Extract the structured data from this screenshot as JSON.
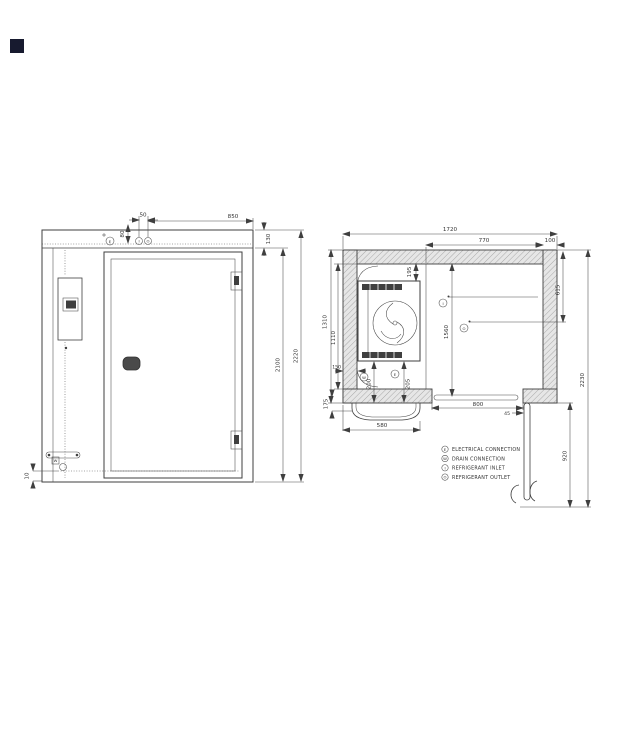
{
  "logo": {
    "color": "#171a2f"
  },
  "front_view": {
    "dims": {
      "d50": "50",
      "d850": "850",
      "d80": "80",
      "d130": "130",
      "d2100": "2100",
      "d2220": "2220",
      "d10": "10"
    },
    "symbols": {
      "electrical": "E",
      "inlet": "I",
      "outlet": "O",
      "drain": "W"
    }
  },
  "plan_view": {
    "dims": {
      "d1720": "1720",
      "d770": "770",
      "d100": "100",
      "d1310": "1310",
      "d1110": "1110",
      "d195": "195",
      "d150": "150",
      "d200": "200",
      "d205": "205",
      "d580": "580",
      "d175": "175",
      "d800": "800",
      "d45": "45",
      "d615": "615",
      "d1560": "1560",
      "d920": "920",
      "d2230": "2230"
    },
    "symbols": {
      "drain": "W",
      "electrical": "E",
      "inlet": "I",
      "outlet": "O"
    }
  },
  "legend": {
    "items": [
      {
        "symbol": "E",
        "label": "ELECTRICAL CONNECTION"
      },
      {
        "symbol": "W",
        "label": "DRAIN CONNECTION"
      },
      {
        "symbol": "I",
        "label": "REFRIGERANT INLET"
      },
      {
        "symbol": "O",
        "label": "REFRIGERANT OUTLET"
      }
    ]
  },
  "colors": {
    "line": "#3f3f3f",
    "hatch_bg": "#e6e6e6",
    "hatch_line": "#a8a8a8"
  }
}
